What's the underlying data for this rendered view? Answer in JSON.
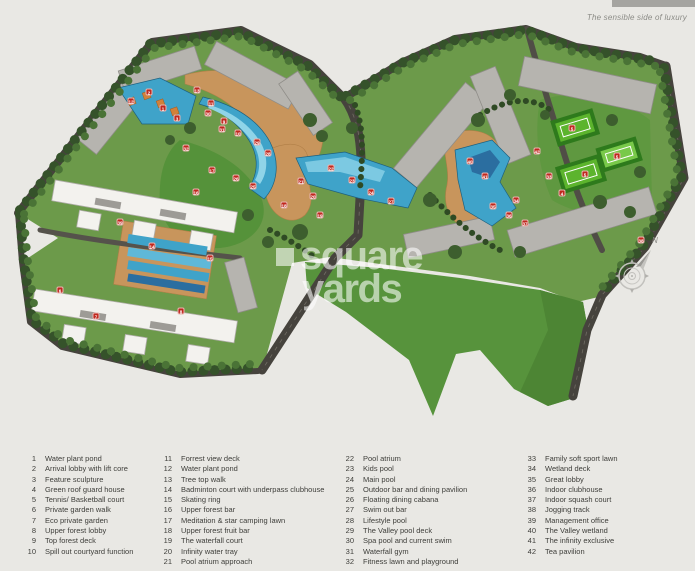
{
  "branding": {
    "tagline": "The sensible side of luxury",
    "watermark": {
      "word1": "square",
      "word2": "yards"
    }
  },
  "compass": {
    "north": "N"
  },
  "colors": {
    "marker_red": "#c0281e",
    "pool_blue": "#3fa3c9",
    "lawn_green": "#57933c",
    "tree_green": "#35522a",
    "deck_tan": "#c8955c",
    "road_dark": "#46433d",
    "building_gray": "#b6b4af",
    "building_white": "#f3f2ee",
    "court_green": "#5cb42d",
    "background": "#e9e8e4"
  },
  "map": {
    "markers": [
      {
        "n": "2",
        "x": 149,
        "y": 92
      },
      {
        "n": "12",
        "x": 131,
        "y": 101
      },
      {
        "n": "1",
        "x": 163,
        "y": 108
      },
      {
        "n": "3",
        "x": 177,
        "y": 118
      },
      {
        "n": "13",
        "x": 197,
        "y": 90
      },
      {
        "n": "11",
        "x": 211,
        "y": 103
      },
      {
        "n": "30",
        "x": 208,
        "y": 113
      },
      {
        "n": "9",
        "x": 224,
        "y": 121
      },
      {
        "n": "10",
        "x": 238,
        "y": 133
      },
      {
        "n": "31",
        "x": 222,
        "y": 129
      },
      {
        "n": "29",
        "x": 257,
        "y": 142
      },
      {
        "n": "28",
        "x": 268,
        "y": 153
      },
      {
        "n": "32",
        "x": 186,
        "y": 148
      },
      {
        "n": "17",
        "x": 212,
        "y": 170
      },
      {
        "n": "26",
        "x": 236,
        "y": 178
      },
      {
        "n": "25",
        "x": 253,
        "y": 186
      },
      {
        "n": "16",
        "x": 196,
        "y": 192
      },
      {
        "n": "18",
        "x": 284,
        "y": 205
      },
      {
        "n": "19",
        "x": 320,
        "y": 215
      },
      {
        "n": "21",
        "x": 301,
        "y": 181
      },
      {
        "n": "20",
        "x": 313,
        "y": 196
      },
      {
        "n": "22",
        "x": 331,
        "y": 168
      },
      {
        "n": "23",
        "x": 352,
        "y": 180
      },
      {
        "n": "24",
        "x": 371,
        "y": 192
      },
      {
        "n": "27",
        "x": 391,
        "y": 201
      },
      {
        "n": "40",
        "x": 470,
        "y": 161
      },
      {
        "n": "41",
        "x": 485,
        "y": 176
      },
      {
        "n": "42",
        "x": 537,
        "y": 151
      },
      {
        "n": "33",
        "x": 549,
        "y": 176
      },
      {
        "n": "34",
        "x": 516,
        "y": 200
      },
      {
        "n": "35",
        "x": 493,
        "y": 206
      },
      {
        "n": "36",
        "x": 509,
        "y": 215
      },
      {
        "n": "37",
        "x": 525,
        "y": 223
      },
      {
        "n": "5",
        "x": 572,
        "y": 128
      },
      {
        "n": "5",
        "x": 617,
        "y": 156
      },
      {
        "n": "5",
        "x": 585,
        "y": 174
      },
      {
        "n": "4",
        "x": 562,
        "y": 193
      },
      {
        "n": "38",
        "x": 641,
        "y": 240
      },
      {
        "n": "39",
        "x": 120,
        "y": 222
      },
      {
        "n": "14",
        "x": 152,
        "y": 246
      },
      {
        "n": "15",
        "x": 210,
        "y": 258
      },
      {
        "n": "6",
        "x": 60,
        "y": 290
      },
      {
        "n": "7",
        "x": 96,
        "y": 316
      },
      {
        "n": "8",
        "x": 181,
        "y": 311
      }
    ]
  },
  "legend": {
    "columns": [
      {
        "items": [
          {
            "num": "1",
            "label": "Water plant pond"
          },
          {
            "num": "2",
            "label": "Arrival lobby with lift core"
          },
          {
            "num": "3",
            "label": "Feature sculpture"
          },
          {
            "num": "4",
            "label": "Green roof guard house"
          },
          {
            "num": "5",
            "label": "Tennis/ Basketball court"
          },
          {
            "num": "6",
            "label": "Private garden walk"
          },
          {
            "num": "7",
            "label": "Eco private garden"
          },
          {
            "num": "8",
            "label": "Upper forest lobby"
          },
          {
            "num": "9",
            "label": "Top forest deck"
          },
          {
            "num": "10",
            "label": "Spill out courtyard function"
          }
        ]
      },
      {
        "items": [
          {
            "num": "11",
            "label": "Forrest view deck"
          },
          {
            "num": "12",
            "label": "Water plant pond"
          },
          {
            "num": "13",
            "label": "Tree top walk"
          },
          {
            "num": "14",
            "label": "Badminton court with underpass clubhouse"
          },
          {
            "num": "15",
            "label": "Skating ring"
          },
          {
            "num": "16",
            "label": "Upper forest bar"
          },
          {
            "num": "17",
            "label": "Meditation & star camping lawn"
          },
          {
            "num": "18",
            "label": "Upper forest fruit bar"
          },
          {
            "num": "19",
            "label": "The waterfall court"
          },
          {
            "num": "20",
            "label": "Infinity water tray"
          },
          {
            "num": "21",
            "label": "Pool atrium approach"
          }
        ]
      },
      {
        "items": [
          {
            "num": "22",
            "label": "Pool atrium"
          },
          {
            "num": "23",
            "label": "Kids pool"
          },
          {
            "num": "24",
            "label": "Main pool"
          },
          {
            "num": "25",
            "label": "Outdoor bar and dining pavilion"
          },
          {
            "num": "26",
            "label": "Floating dining cabana"
          },
          {
            "num": "27",
            "label": "Swim out bar"
          },
          {
            "num": "28",
            "label": "Lifestyle pool"
          },
          {
            "num": "29",
            "label": "The Valley pool deck"
          },
          {
            "num": "30",
            "label": "Spa pool and current swim"
          },
          {
            "num": "31",
            "label": "Waterfall gym"
          },
          {
            "num": "32",
            "label": "Fitness lawn and playground"
          }
        ]
      },
      {
        "items": [
          {
            "num": "33",
            "label": "Family soft sport lawn"
          },
          {
            "num": "34",
            "label": "Wetland deck"
          },
          {
            "num": "35",
            "label": "Great lobby"
          },
          {
            "num": "36",
            "label": "Indoor clubhouse"
          },
          {
            "num": "37",
            "label": "Indoor squash court"
          },
          {
            "num": "38",
            "label": "Jogging track"
          },
          {
            "num": "39",
            "label": "Management office"
          },
          {
            "num": "40",
            "label": "The Valley wetland"
          },
          {
            "num": "41",
            "label": "The infinity exclusive"
          },
          {
            "num": "42",
            "label": "Tea pavilion"
          }
        ]
      }
    ]
  }
}
